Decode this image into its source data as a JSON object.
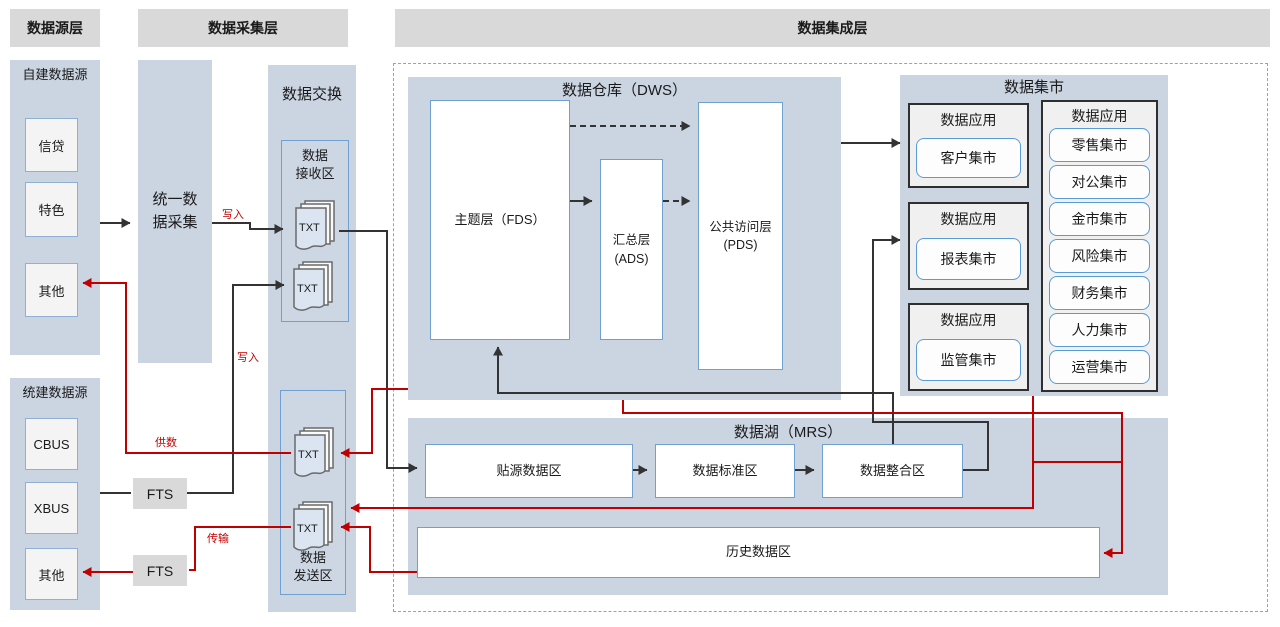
{
  "headers": {
    "source_layer": "数据源层",
    "collection_layer": "数据采集层",
    "integration_layer": "数据集成层"
  },
  "source_layer": {
    "self_built_title": "自建数据源",
    "self_built_items": [
      "信贷",
      "特色",
      "其他"
    ],
    "unified_title": "统建数据源",
    "unified_items": [
      "CBUS",
      "XBUS",
      "其他"
    ]
  },
  "collection_layer": {
    "unified_collection": "统一数\n据采集",
    "fts_label": "FTS"
  },
  "exchange": {
    "title": "数据交换",
    "receive_zone": "数据\n接收区",
    "send_zone": "数据\n发送区",
    "txt_label": "TXT"
  },
  "integration": {
    "dws_title": "数据仓库（DWS）",
    "fds_label": "主题层（FDS）",
    "ads_label": "汇总层\n(ADS)",
    "pds_label": "公共访问层\n(PDS)",
    "marts_title": "数据集市",
    "data_app_label": "数据应用",
    "mart_left_items": [
      "客户集市",
      "报表集市",
      "监管集市"
    ],
    "mart_right_items": [
      "零售集市",
      "对公集市",
      "金市集市",
      "风险集市",
      "财务集市",
      "人力集市",
      "运营集市"
    ],
    "mrs_title": "数据湖（MRS）",
    "mrs_zones": [
      "贴源数据区",
      "数据标准区",
      "数据整合区"
    ],
    "history_label": "历史数据区"
  },
  "edge_labels": {
    "write": "写入",
    "supply": "供数",
    "transfer": "传输"
  },
  "colors": {
    "accent_blue": "#6fa0cf",
    "panel_blue": "#cbd5e2",
    "header_gray": "#d9d9d9",
    "line_dark": "#333333",
    "line_red": "#c00000"
  }
}
